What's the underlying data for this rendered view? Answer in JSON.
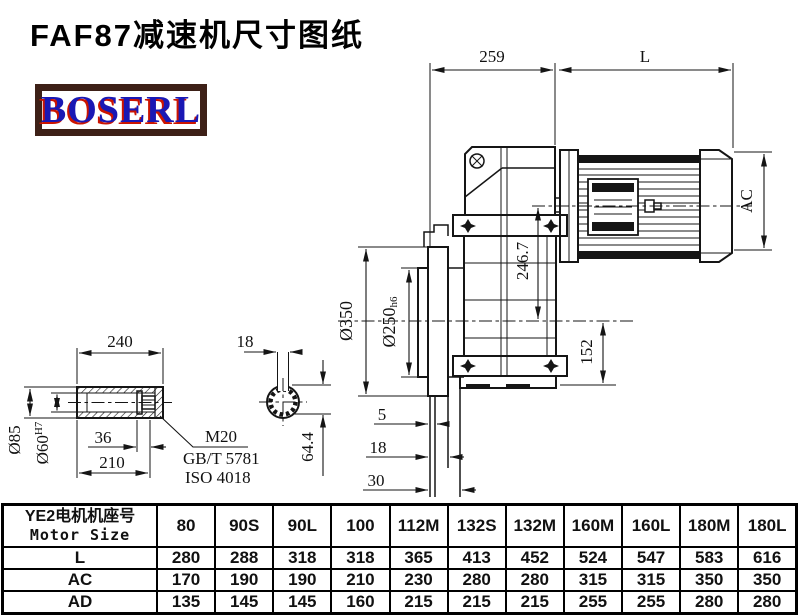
{
  "title": "FAF87减速机尺寸图纸",
  "logo": {
    "text": "BOSERL"
  },
  "drawing": {
    "dims": {
      "d259": "259",
      "dL": "L",
      "dAC": "AC",
      "d246_7": "246.7",
      "d152": "152",
      "d350": "Ø350",
      "d250": "Ø250",
      "d250tol": "h6",
      "d5": "5",
      "d18": "18",
      "d30": "30"
    },
    "shaft": {
      "d240": "240",
      "d36": "36",
      "d210": "210",
      "d85": "Ø85",
      "d60": "Ø60",
      "d60tol": "H7",
      "bolt": "M20",
      "std1": "GB/T 5781",
      "std2": "ISO 4018",
      "key18": "18",
      "key644": "64.4"
    }
  },
  "table": {
    "header_cn": "YE2电机机座号",
    "header_en": "Motor Size",
    "columns": [
      "80",
      "90S",
      "90L",
      "100",
      "112M",
      "132S",
      "132M",
      "160M",
      "160L",
      "180M",
      "180L"
    ],
    "rows": [
      {
        "label": "L",
        "values": [
          "280",
          "288",
          "318",
          "318",
          "365",
          "413",
          "452",
          "524",
          "547",
          "583",
          "616"
        ]
      },
      {
        "label": "AC",
        "values": [
          "170",
          "190",
          "190",
          "210",
          "230",
          "280",
          "280",
          "315",
          "315",
          "350",
          "350"
        ]
      },
      {
        "label": "AD",
        "values": [
          "135",
          "145",
          "145",
          "160",
          "215",
          "215",
          "215",
          "255",
          "255",
          "280",
          "280"
        ]
      }
    ]
  }
}
